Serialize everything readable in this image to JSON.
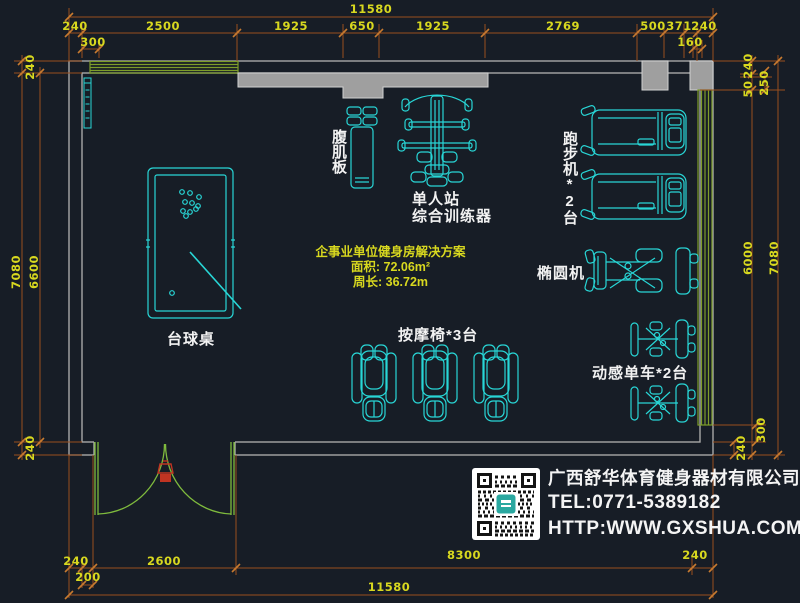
{
  "drawing": {
    "summary": {
      "title": "企事业单位健身房解决方案",
      "area": "面积: 72.06m²",
      "perimeter": "周长: 36.72m"
    },
    "equipment_labels": {
      "ab_board": "腹肌板",
      "trainer_line1": "单人站",
      "trainer_line2": "综合训练器",
      "treadmill": "跑步机*2台",
      "elliptical": "椭圆机",
      "billiard": "台球桌",
      "massage_chair": "按摩椅*3台",
      "spin_bike": "动感单车*2台"
    }
  },
  "dimensions": {
    "top": {
      "total": "11580",
      "segments": [
        "240",
        "2500",
        "1925",
        "650",
        "1925",
        "2769",
        "500",
        "371",
        "240"
      ],
      "sub_left": "300",
      "sub_right": "160"
    },
    "left": {
      "wall_top": "240",
      "outer": "7080",
      "inner": "6600",
      "wall_bottom": "240"
    },
    "right": {
      "wall_top": "240",
      "gap": "50",
      "column": "250",
      "inner": "6000",
      "outer": "7080",
      "window_offset": "300",
      "wall_bottom": "240"
    },
    "bottom": {
      "segments": [
        "240",
        "2600",
        "8300",
        "240"
      ],
      "sub": "200",
      "total": "11580"
    }
  },
  "company": {
    "name": "广西舒华体育健身器材有限公司",
    "tel": "TEL:0771-5389182",
    "web": "HTTP:WWW.GXSHUA.COM"
  },
  "colors": {
    "background": "#171d26",
    "dimension_line": "#9a4f1e",
    "dimension_text": "#d8d81f",
    "wall": "#a8a8a8",
    "window": "#7e9e2a",
    "door": "#7fbb3d",
    "equipment": "#28d6d6",
    "label": "#f2f2f2",
    "red_marker": "#c03422"
  }
}
